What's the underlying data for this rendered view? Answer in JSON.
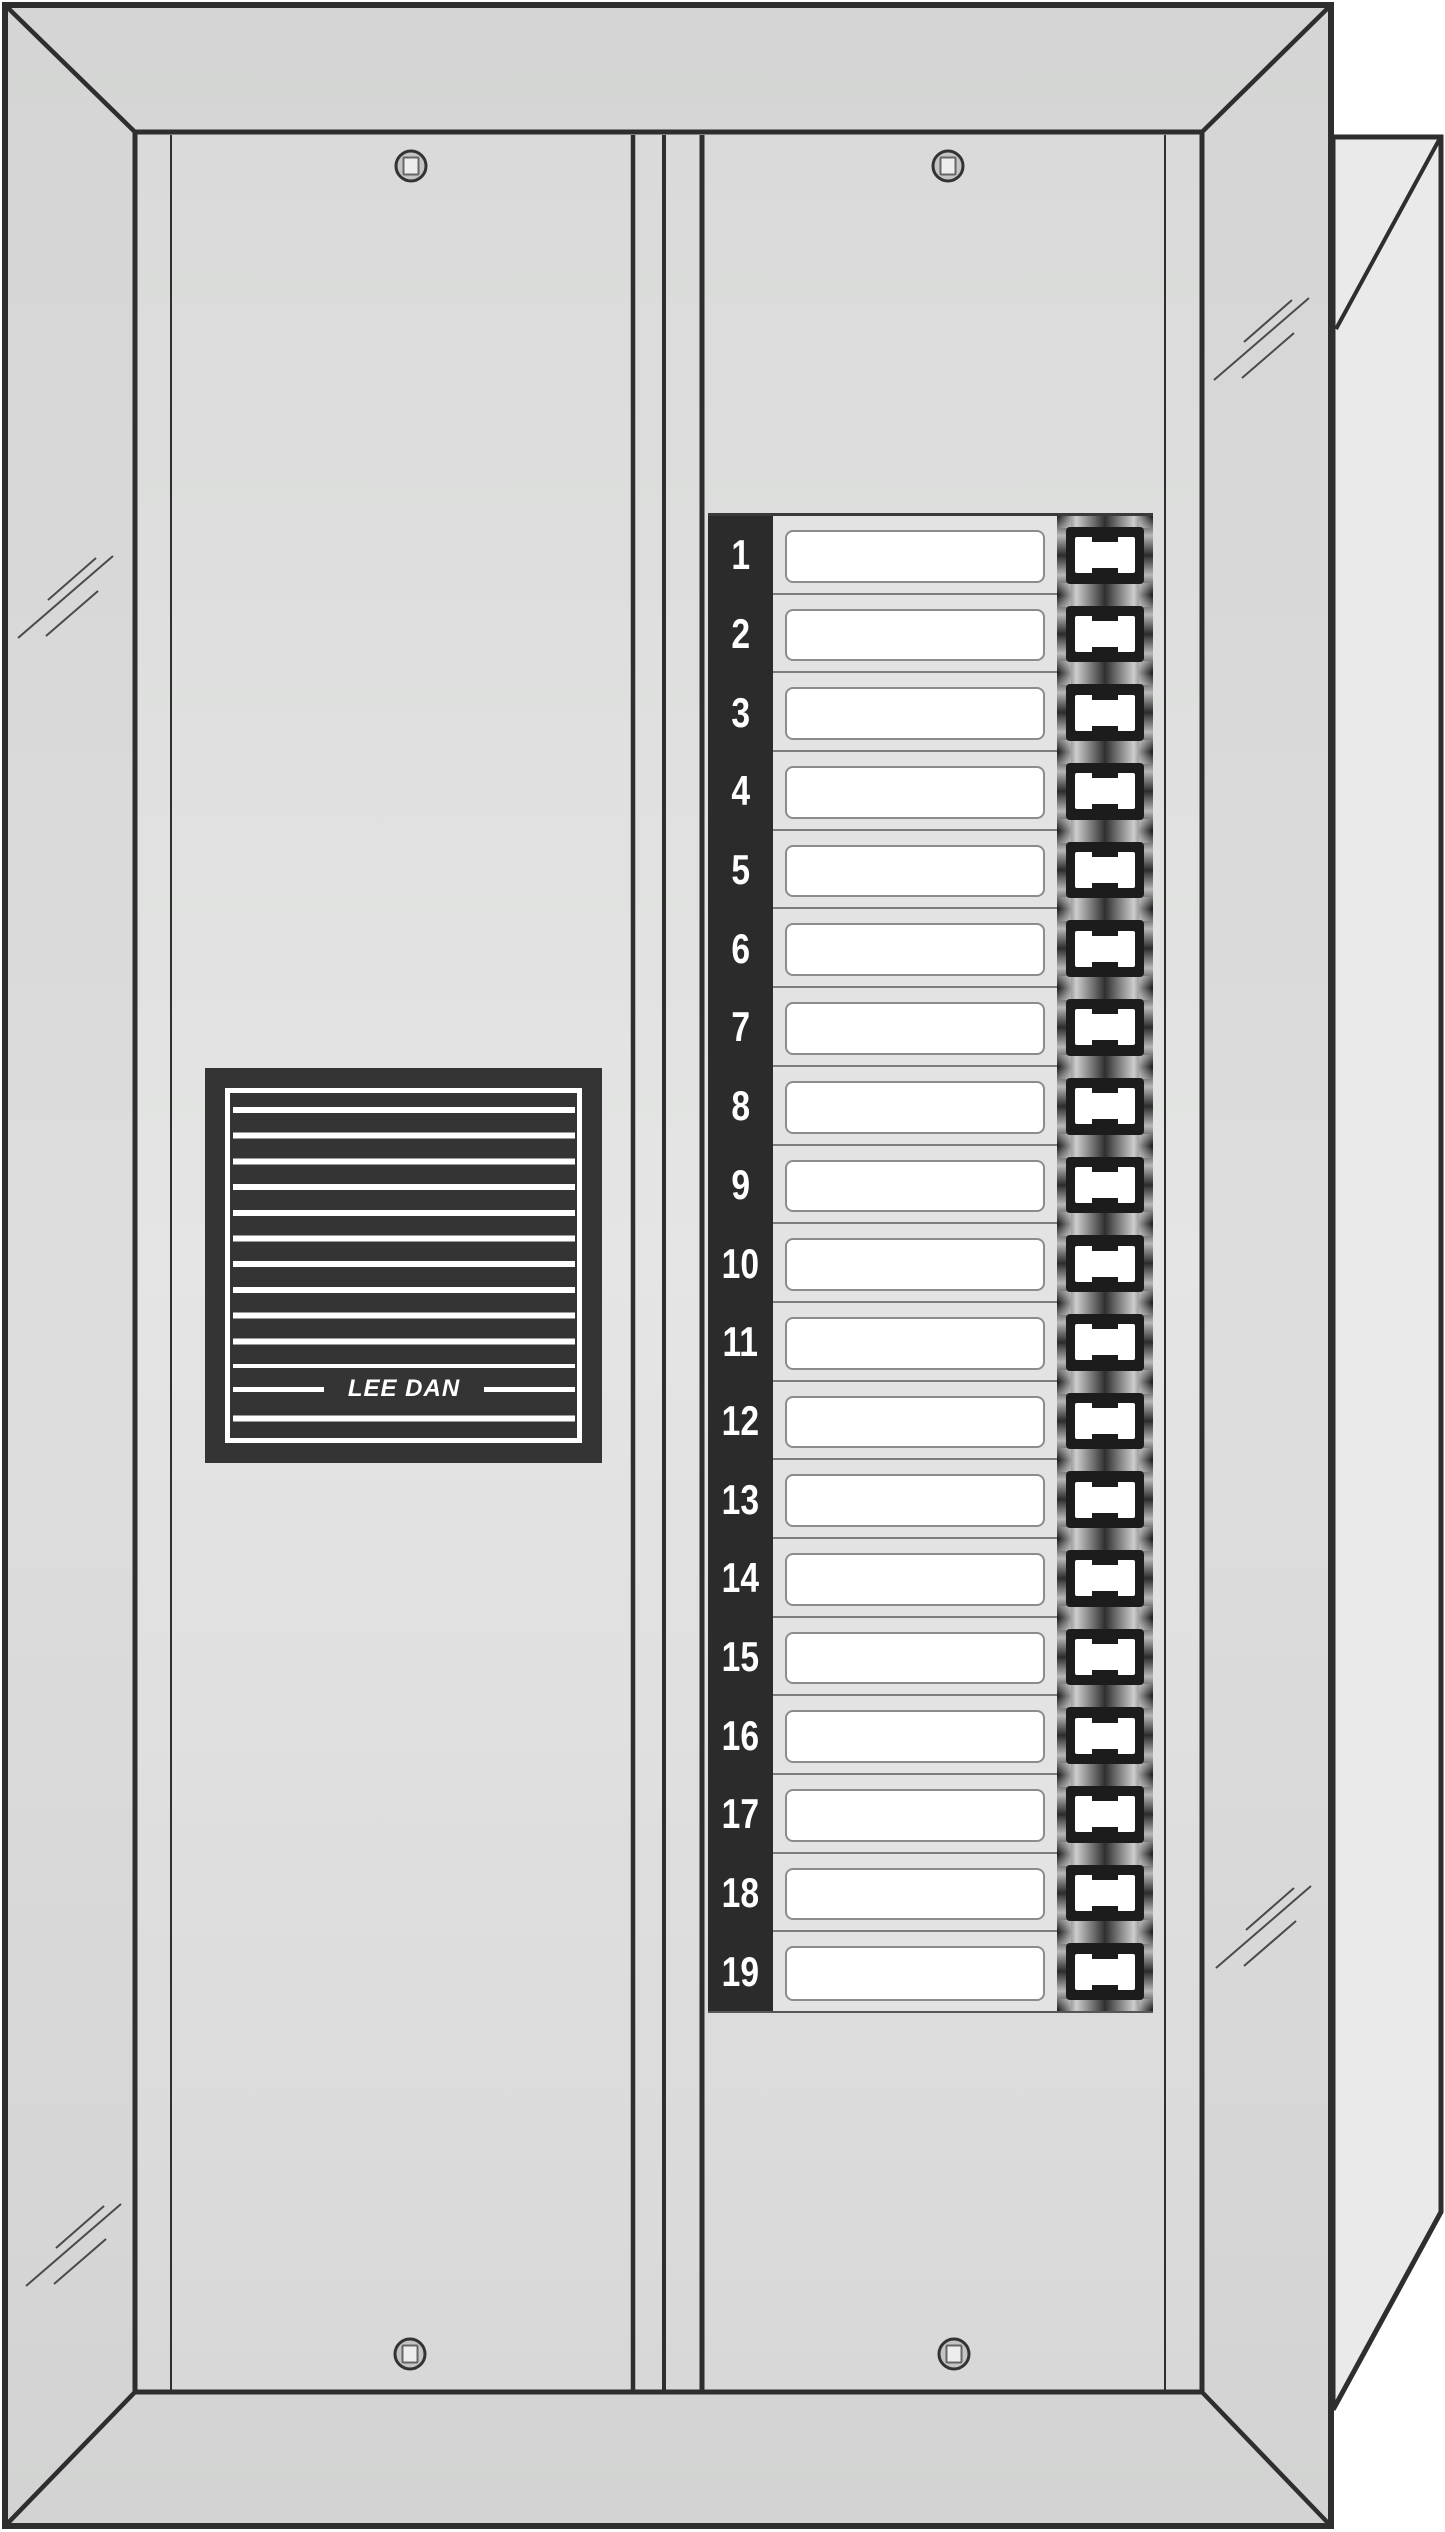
{
  "brand": "LEE DAN",
  "directory": {
    "rows": [
      {
        "number": "1",
        "card": ""
      },
      {
        "number": "2",
        "card": ""
      },
      {
        "number": "3",
        "card": ""
      },
      {
        "number": "4",
        "card": ""
      },
      {
        "number": "5",
        "card": ""
      },
      {
        "number": "6",
        "card": ""
      },
      {
        "number": "7",
        "card": ""
      },
      {
        "number": "8",
        "card": ""
      },
      {
        "number": "9",
        "card": ""
      },
      {
        "number": "10",
        "card": ""
      },
      {
        "number": "11",
        "card": ""
      },
      {
        "number": "12",
        "card": ""
      },
      {
        "number": "13",
        "card": ""
      },
      {
        "number": "14",
        "card": ""
      },
      {
        "number": "15",
        "card": ""
      },
      {
        "number": "16",
        "card": ""
      },
      {
        "number": "17",
        "card": ""
      },
      {
        "number": "18",
        "card": ""
      },
      {
        "number": "19",
        "card": ""
      }
    ]
  },
  "hardware": {
    "screw_count": 4
  },
  "colors": {
    "outline": "#2e2e2e",
    "frame_face": "#d7d8d7",
    "panel_light": "#e3e4e3",
    "flange": "#eaeaea",
    "grille_dark": "#343434",
    "number_strip": "#2b2b2b",
    "button_strip": "#232323",
    "card_white": "#ffffff"
  }
}
